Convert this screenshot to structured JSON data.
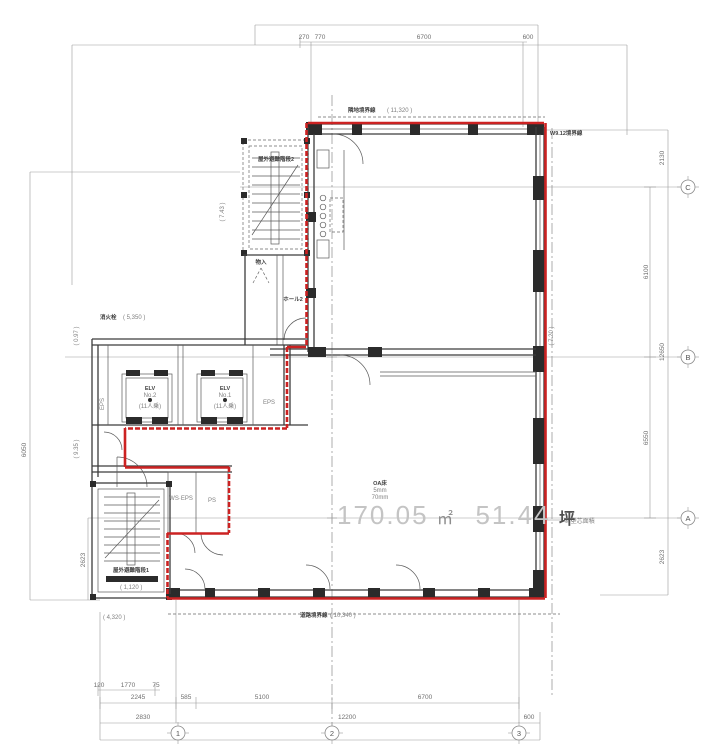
{
  "colors": {
    "lease_line": "#cc2222",
    "walls": "#3c3c3c",
    "dimensions": "#9a9a9a",
    "area_text": "#c4c4c4"
  },
  "area_label": {
    "sqm_value": "170.05",
    "sqm_unit": "㎡",
    "tsubo_value": "51.44",
    "tsubo_unit": "坪"
  },
  "office_note": [
    "OA床",
    "5mm",
    "70mm"
  ],
  "dims_top": [
    "270",
    "770",
    "6700",
    "600"
  ],
  "dims_bottom_row1": [
    "120",
    "1770",
    "75"
  ],
  "dims_bottom_row2": [
    "2245",
    "585",
    "5100",
    "6700"
  ],
  "dims_bottom_row3": [
    "2830",
    "12200",
    "600"
  ],
  "dims_right_inner": [
    "6100",
    "6550"
  ],
  "dims_right_outer": [
    "2130",
    "12650",
    "2623"
  ],
  "dims_left": {
    "total": "6050",
    "bottom": "2623"
  },
  "grid_cols": [
    "1",
    "2",
    "3"
  ],
  "grid_rows": [
    "C",
    "B",
    "A"
  ],
  "elevations": {
    "top": "( 11,320 )",
    "bottom": "( 10,340 )",
    "left_upper": "( 7.43 )",
    "left_mid": "( 5,350 )",
    "left_low1": "( 0.97 )",
    "left_low2": "( 9.35 )",
    "right_mid": "( 7.20 )",
    "stair_bottom": "( 4,320 )",
    "stair_note": "( 1,120 )"
  },
  "bold_notes": {
    "top": "隣地境界線",
    "bottom": "道路境界線",
    "top_right": "W9.12境界線",
    "left_mid": "消火栓",
    "right_note": "※ 壁芯面積"
  },
  "rooms": {
    "stair2": "屋外避難階段2",
    "stair1": "屋外避難階段1",
    "hall2": "ホール2",
    "storage": "物入",
    "eps": "EPS",
    "ws_eps": "WS·EPS",
    "ps": "PS",
    "elv1": {
      "l1": "ELV",
      "l2": "No.1",
      "l3": "(11人乗)"
    },
    "elv2": {
      "l1": "ELV",
      "l2": "No.2",
      "l3": "(11人乗)"
    }
  }
}
